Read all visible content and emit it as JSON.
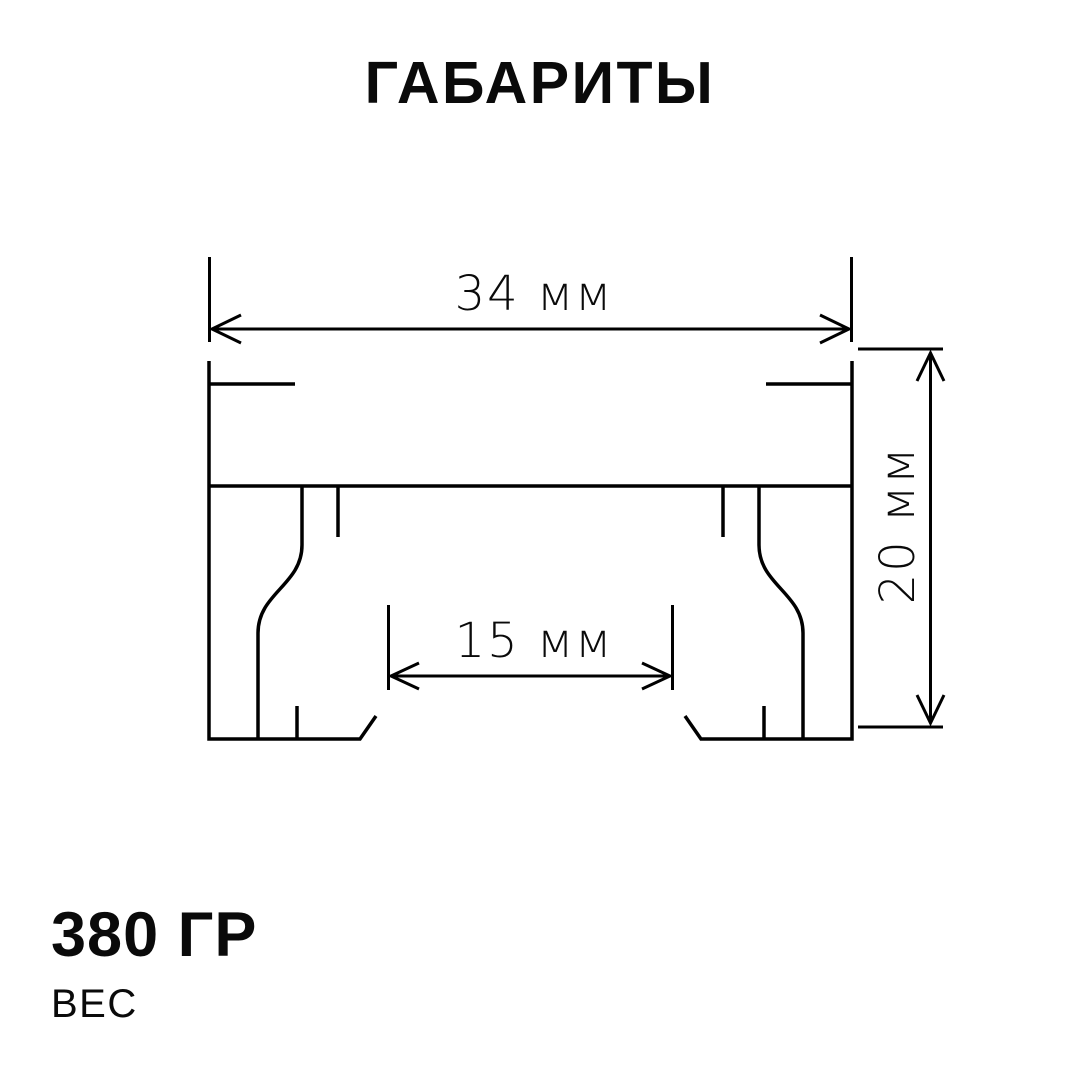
{
  "page": {
    "background": "#ffffff",
    "ink": "#000000"
  },
  "title": "ГАБАРИТЫ",
  "diagram": {
    "type": "technical-dimension-drawing",
    "subject": "profile cross-section with two legs and chamfered feet",
    "width": {
      "label": "34 мм",
      "value": 34,
      "unit": "мм",
      "placement": "top-horizontal"
    },
    "height": {
      "label": "20 мм",
      "value": 20,
      "unit": "мм",
      "placement": "right-vertical-rotated"
    },
    "inner_width": {
      "label": "15 мм",
      "value": 15,
      "unit": "мм",
      "placement": "inner-horizontal"
    }
  },
  "weight": {
    "value": "380 ГР",
    "label": "ВЕС"
  }
}
